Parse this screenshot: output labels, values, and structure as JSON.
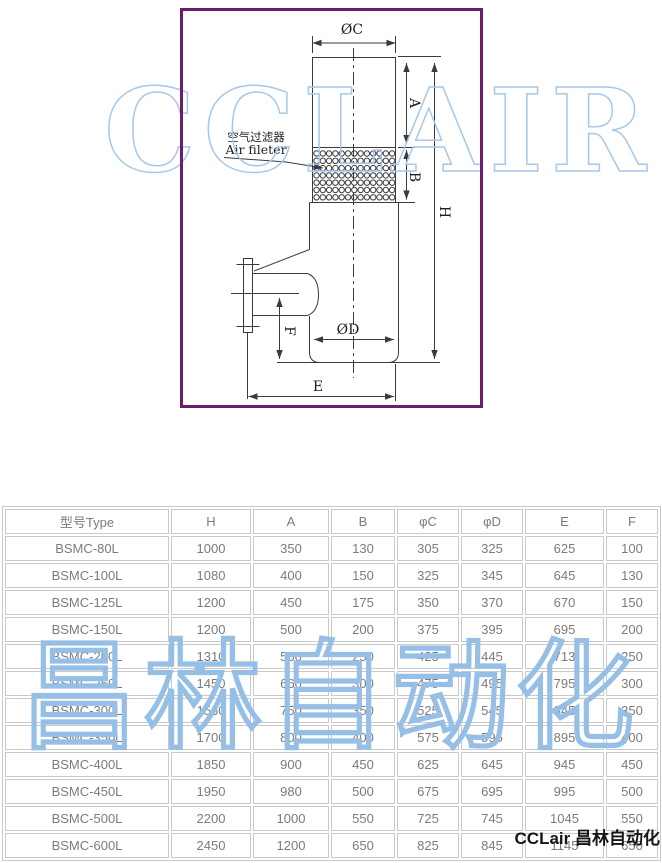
{
  "watermarks": {
    "latin": "CCLAIR",
    "cjk": "昌林自动化"
  },
  "footer": {
    "brand": "CCLair 昌林自动化"
  },
  "diagram": {
    "frame_color": "#6a1c6e",
    "watermark_color": "#a5c8ea",
    "labels": {
      "phi_c": "ØC",
      "phi_d": "ØD",
      "dim_a": "A",
      "dim_b": "B",
      "dim_h": "H",
      "dim_e": "E",
      "dim_f": "F",
      "filter_cn": "空气过滤器",
      "filter_en": "Air fileter"
    },
    "perforation": {
      "cols": 13,
      "rows": 7,
      "x": 316.5,
      "y": 153.5,
      "dx": 6.3,
      "dy": 7.3,
      "r": 2.7
    }
  },
  "table": {
    "headers": [
      "型号Type",
      "H",
      "A",
      "B",
      "φC",
      "φD",
      "E",
      "F"
    ],
    "rows": [
      [
        "BSMC-80L",
        "1000",
        "350",
        "130",
        "305",
        "325",
        "625",
        "100"
      ],
      [
        "BSMC-100L",
        "1080",
        "400",
        "150",
        "325",
        "345",
        "645",
        "130"
      ],
      [
        "BSMC-125L",
        "1200",
        "450",
        "175",
        "350",
        "370",
        "670",
        "150"
      ],
      [
        "BSMC-150L",
        "1200",
        "500",
        "200",
        "375",
        "395",
        "695",
        "200"
      ],
      [
        "BSMC-200L",
        "1310",
        "560",
        "250",
        "425",
        "445",
        "713",
        "250"
      ],
      [
        "BSMC-250L",
        "1450",
        "660",
        "300",
        "475",
        "495",
        "795",
        "300"
      ],
      [
        "BSMC-300L",
        "1560",
        "750",
        "350",
        "525",
        "545",
        "845",
        "350"
      ],
      [
        "BSMC-350L",
        "1700",
        "800",
        "400",
        "575",
        "595",
        "895",
        "400"
      ],
      [
        "BSMC-400L",
        "1850",
        "900",
        "450",
        "625",
        "645",
        "945",
        "450"
      ],
      [
        "BSMC-450L",
        "1950",
        "980",
        "500",
        "675",
        "695",
        "995",
        "500"
      ],
      [
        "BSMC-500L",
        "2200",
        "1000",
        "550",
        "725",
        "745",
        "1045",
        "550"
      ],
      [
        "BSMC-600L",
        "2450",
        "1200",
        "650",
        "825",
        "845",
        "1145",
        "650"
      ]
    ]
  }
}
